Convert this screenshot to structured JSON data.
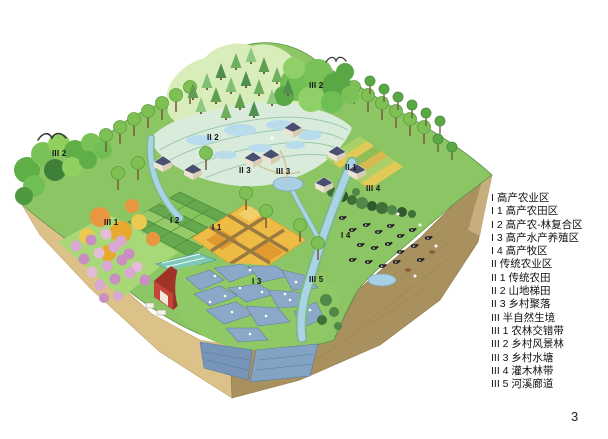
{
  "figure": {
    "kind": "isometric-landscape-diagram",
    "page_number": "3"
  },
  "legend": {
    "items": [
      "I 高产农业区",
      "I 1 高产农田区",
      "I 2 高产农-林复合区",
      "I 3 高产水产养殖区",
      "I 4 高产牧区",
      "II 传统农业区",
      "II 1 传统农田",
      "II 2 山地梯田",
      "II 3 乡村聚落",
      "III 半自然生境",
      "III 1 农林交错带",
      "III 2 乡村风景林",
      "III 3 乡村水塘",
      "III 4 灌木林带",
      "III 5 河溪廊道"
    ]
  },
  "map_labels": [
    {
      "text": "III 2"
    },
    {
      "text": "II 2"
    },
    {
      "text": "III 2"
    },
    {
      "text": "II 3"
    },
    {
      "text": "III 3"
    },
    {
      "text": "II 1"
    },
    {
      "text": "III 4"
    },
    {
      "text": "I 4"
    },
    {
      "text": "III 1"
    },
    {
      "text": "I 2"
    },
    {
      "text": "I 1"
    },
    {
      "text": "I 3"
    },
    {
      "text": "III 5"
    }
  ],
  "colors": {
    "grass": "#8cc563",
    "pale_hill": "#d8edba",
    "terrace": "#d9ecdc",
    "terrace_line": "#9cc8ae",
    "paddy_water": "#b8dcec",
    "fishpond_blue": "#8ba8c8",
    "stream": "#a9d4e5",
    "paddy_gold": "#eebb44",
    "path_brown": "#9a7a40",
    "soil_left_face": "#dcc189",
    "soil_right_face": "#a8905f",
    "pond_cross_section": "#7fa3c5",
    "tree_green": "#7fc055",
    "shrub_dark": "#3f7038",
    "autumn_orange": "#e8973f",
    "blossom_pink": "#d9a8d3",
    "roof_slate": "#4a4f6f",
    "barn_red": "#c5453b",
    "cattle_black": "#222222",
    "label_text": "#141414"
  }
}
